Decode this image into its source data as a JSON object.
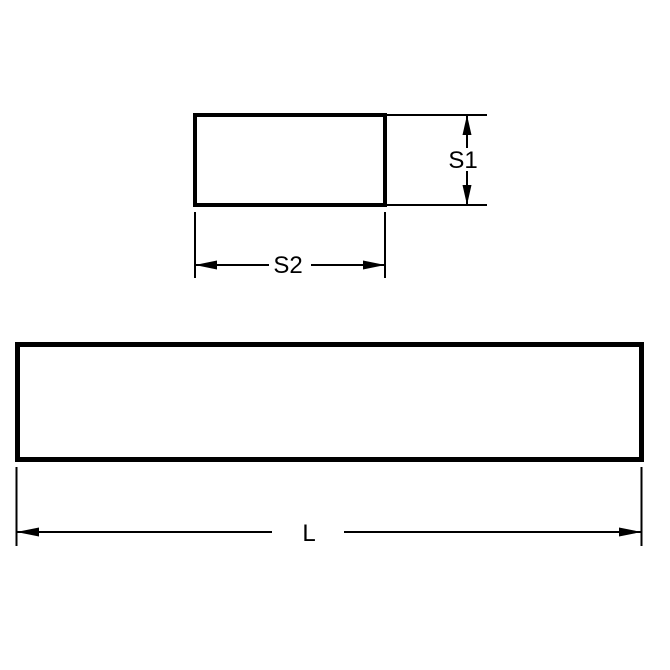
{
  "page": {
    "background_color": "#ffffff"
  },
  "diagram": {
    "kind": "technical-drawing",
    "line_color": "#000000",
    "labels": {
      "s1": "S1",
      "s2": "S2",
      "length": "L"
    }
  }
}
